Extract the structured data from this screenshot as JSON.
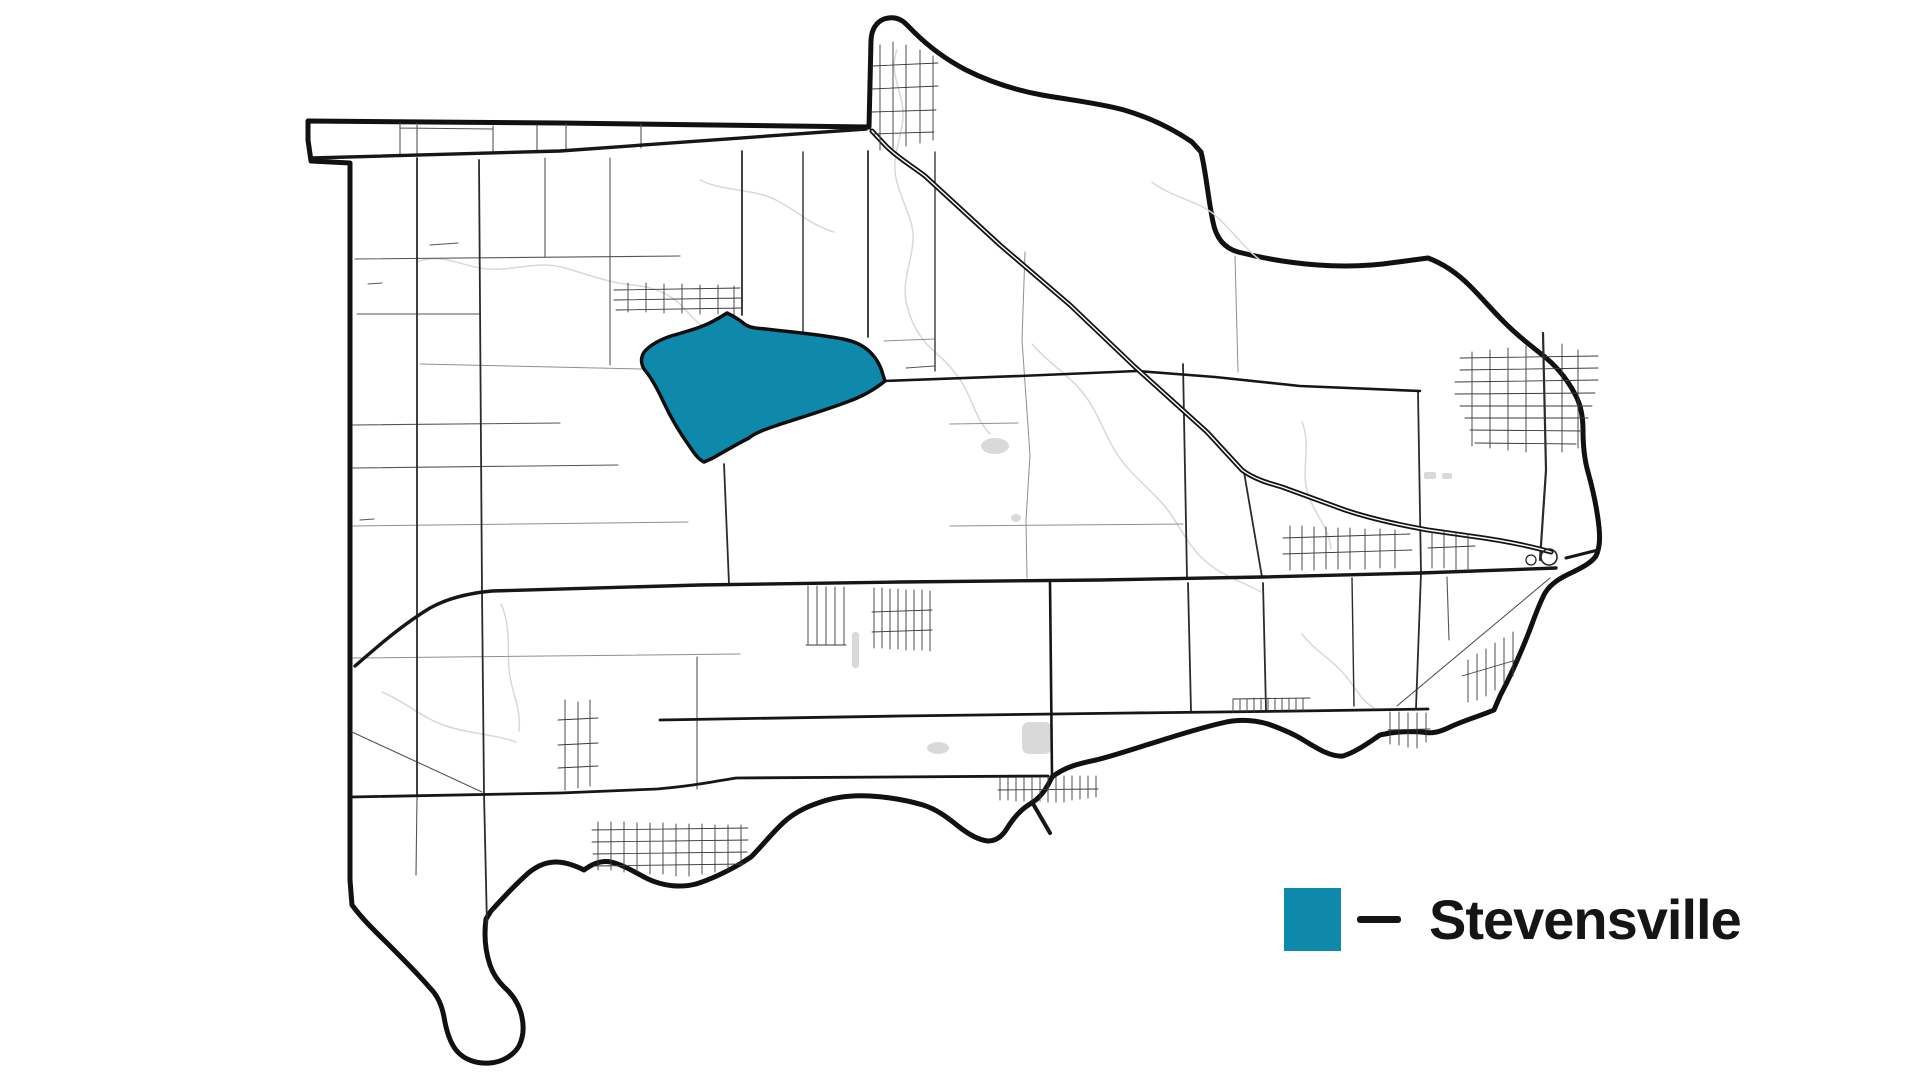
{
  "legend": {
    "label": "Stevensville"
  },
  "colors": {
    "region_fill": "#0F89AB",
    "region_stroke": "#0e0e0e",
    "boundary": "#111111",
    "legend_text": "#151515",
    "creek": "#d8d8d8",
    "pond": "#d9d9d9"
  }
}
